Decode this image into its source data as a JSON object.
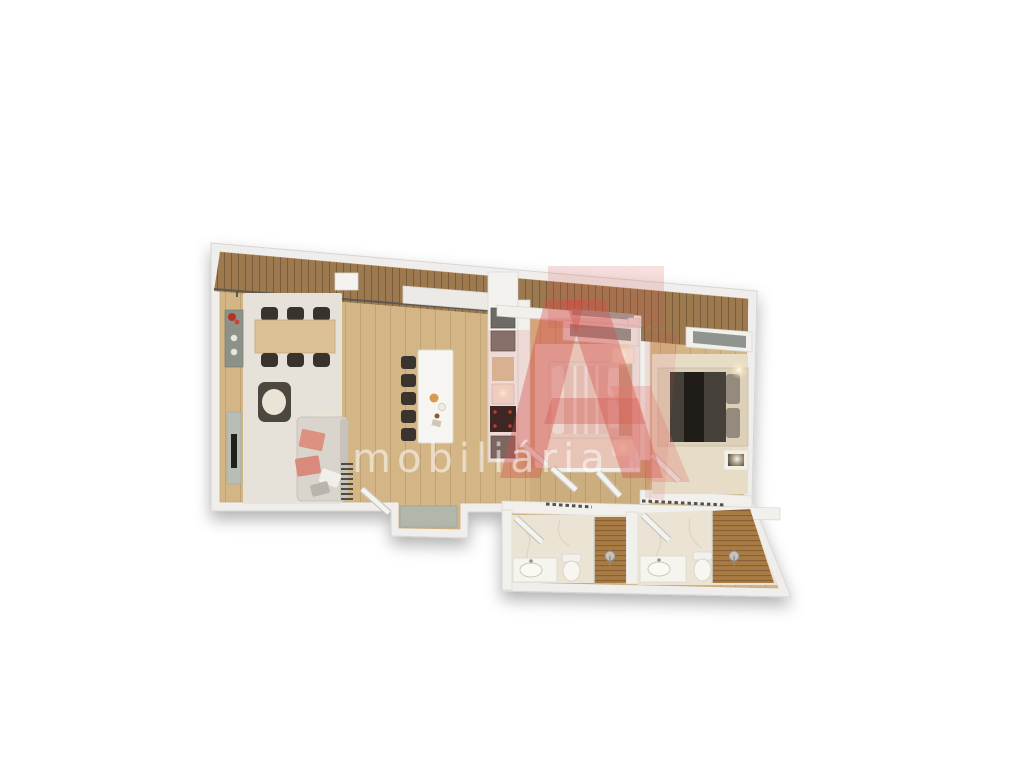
{
  "canvas": {
    "width": 1024,
    "height": 768,
    "background": "#ffffff"
  },
  "watermark": {
    "text": "mobiliária",
    "text_color": "rgba(255,255,255,0.52)",
    "logo_color": "#d24d46"
  },
  "palette": {
    "wall": "#efeeec",
    "wall_edge": "#d8d6d1",
    "floor_wood": "#d4b686",
    "terrace_wood": "#9d7950",
    "rug_living": "#e6e2d9",
    "rug_bedroom1": "#ecdccd",
    "rug_bedroom2": "#e7ddc6",
    "marble": "#ebe4d5",
    "shower_wood": "#a87a44",
    "furniture_dark": "#38342d",
    "table_wood": "#dcc096",
    "sofa": "#d9d5cc",
    "cushion_pink": "#dc9183",
    "armchair_frame": "#4c473f",
    "sideboard": "#8d9288",
    "appliance_gray": "#6f6b64",
    "cooktop": "#26201e",
    "accent_red": "#c23b2e",
    "glass": "#b4bfbd",
    "mat": "#b3b7ab",
    "wardrobe_panel": "#8f948e",
    "bed2_duvet": "#46403a",
    "rail": "#5c5852",
    "glow": "#fff3df"
  },
  "floorplan": {
    "view": "3d-top-down-apartment-render",
    "rooms": [
      {
        "name": "living-dining-kitchen",
        "furniture": [
          "dining table",
          "6 dining chairs",
          "sideboard with red flowers",
          "armchair",
          "sofa with pink cushions",
          "tv console",
          "kitchen island",
          "5 bar stools",
          "kitchen counter with oven, sink and cooktop",
          "radiator",
          "floor lamp"
        ]
      },
      {
        "name": "bedroom-1",
        "furniture": [
          "double bed",
          "2 nightstands with lamps",
          "built-in wardrobe"
        ]
      },
      {
        "name": "bedroom-2",
        "furniture": [
          "double bed with dark duvet",
          "nightstand with lamp",
          "built-in wardrobe"
        ]
      },
      {
        "name": "bathroom-1",
        "furniture": [
          "vanity with sink",
          "toilet",
          "walk-in shower"
        ]
      },
      {
        "name": "bathroom-2",
        "furniture": [
          "vanity with sink",
          "toilet",
          "walk-in shower"
        ]
      },
      {
        "name": "entry-vestibule",
        "furniture": [
          "doormat"
        ]
      },
      {
        "name": "terrace-strip",
        "furniture": [
          "wood decking"
        ]
      }
    ],
    "counts": {
      "bedrooms": 2,
      "bathrooms": 2,
      "dining_chairs": 6,
      "bar_stools": 5
    }
  }
}
